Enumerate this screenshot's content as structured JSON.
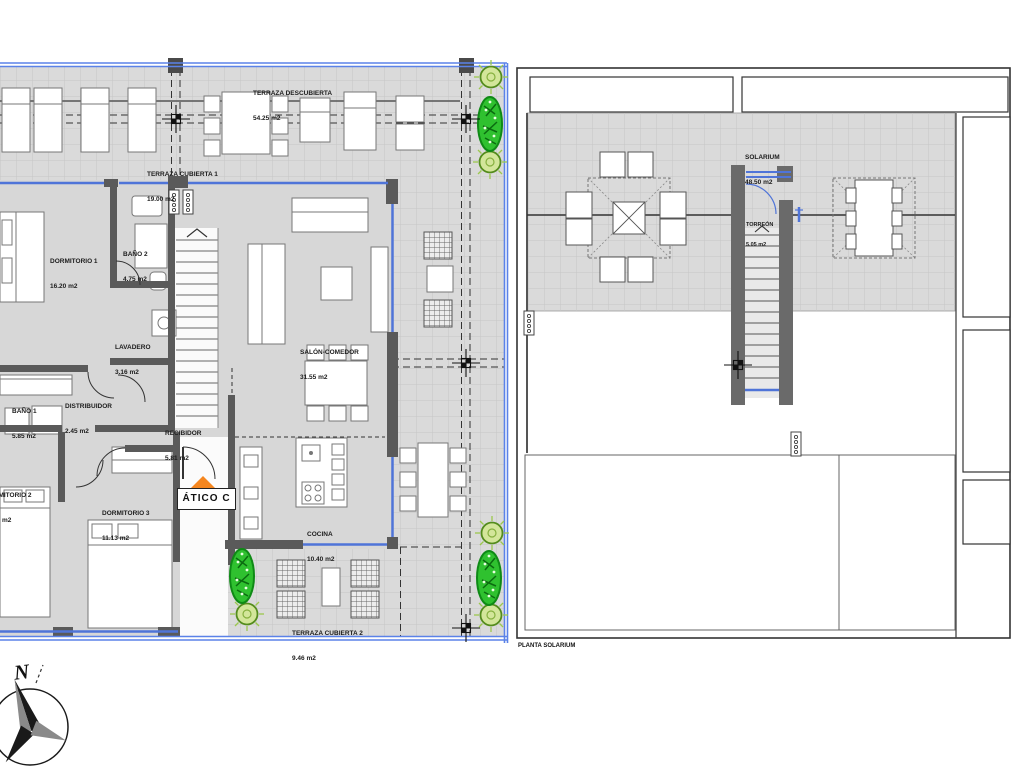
{
  "plan_left": {
    "unit_label": "ÁTICO C",
    "rooms": {
      "terraza_descubierta": {
        "name": "TERRAZA DESCUBIERTA",
        "area": "54.25 m2"
      },
      "terraza_cubierta_1": {
        "name": "TERRAZA CUBIERTA 1",
        "area": "19.00 m2"
      },
      "dormitorio_1": {
        "name": "DORMITORIO 1",
        "area": "16.20 m2"
      },
      "bano_2": {
        "name": "BAÑO 2",
        "area": "4.75 m2"
      },
      "lavadero": {
        "name": "LAVADERO",
        "area": "3.16 m2"
      },
      "salon_comedor": {
        "name": "SALÓN-COMEDOR",
        "area": "31.55 m2"
      },
      "bano_1": {
        "name": "BAÑO 1",
        "area": "5.85 m2"
      },
      "distribuidor": {
        "name": "DISTRIBUIDOR",
        "area": "2.45 m2"
      },
      "recibidor": {
        "name": "RECIBIDOR",
        "area": "5.81 m2"
      },
      "dormitorio_2": {
        "name": "DORMITORIO 2",
        "area": "m2"
      },
      "dormitorio_3": {
        "name": "DORMITORIO 3",
        "area": "11.13 m2"
      },
      "cocina": {
        "name": "COCINA",
        "area": "10.40 m2"
      },
      "terraza_cubierta_2": {
        "name": "TERRAZA CUBIERTA 2",
        "area": "9.46 m2"
      }
    }
  },
  "plan_right": {
    "caption": "PLANTA SOLARIUM",
    "rooms": {
      "solarium": {
        "name": "SOLARIUM",
        "area": "48.50 m2"
      },
      "torreon": {
        "name": "TORREÓN",
        "area": "5.05 m2"
      }
    }
  },
  "compass": {
    "north_label": "N"
  },
  "colors": {
    "window_blue": "#4f74d8",
    "border_blue": "#5b82e8",
    "wall_gray": "#5a5a5a",
    "terrace_gray": "#dadada",
    "plant_green": "#2fc12f",
    "sun_green": "#d3e69a",
    "entrance_orange": "#f5861f"
  }
}
